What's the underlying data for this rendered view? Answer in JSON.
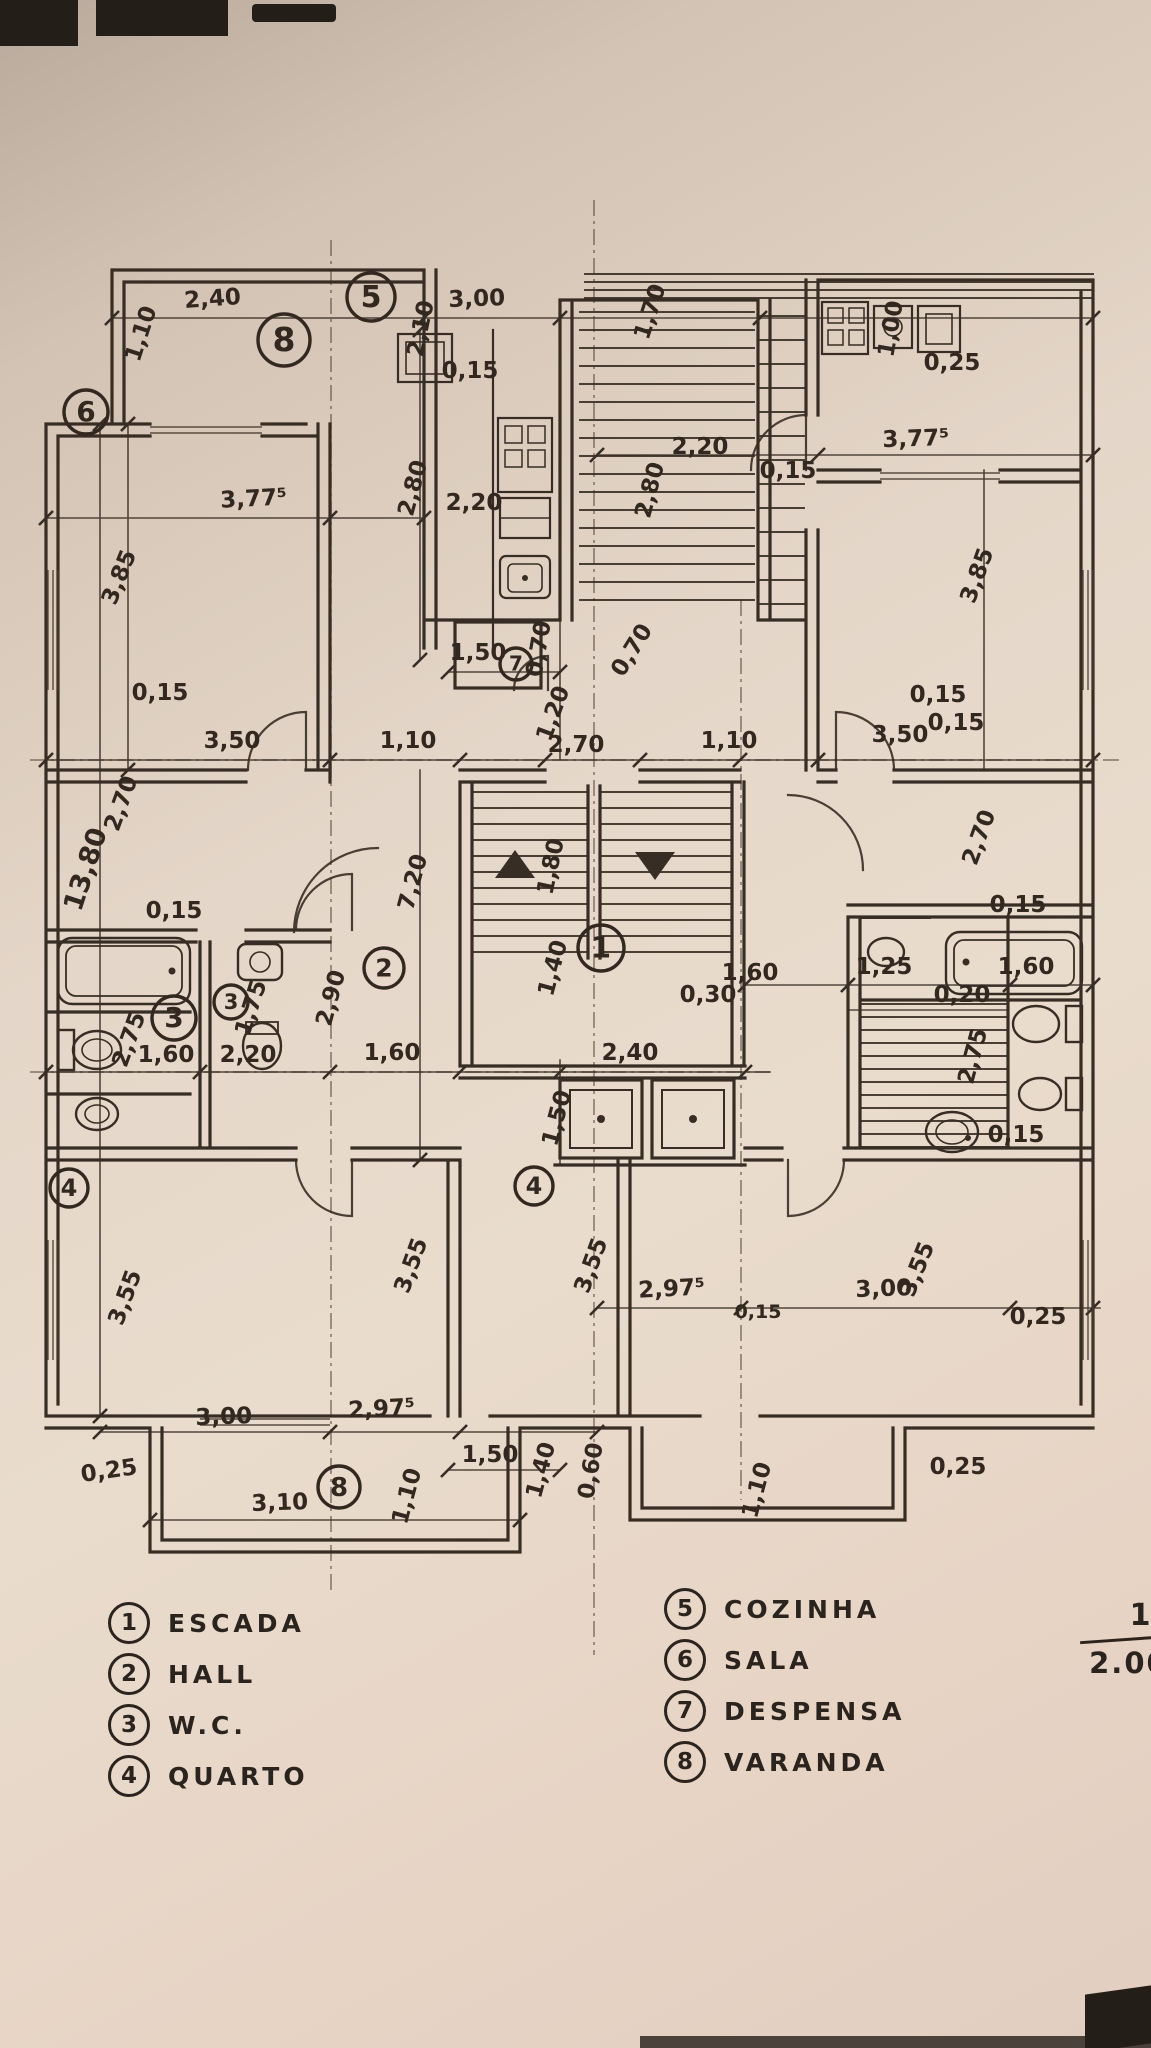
{
  "drawing": {
    "type": "floor plan (planta baixa)",
    "language": "pt",
    "ink_color": "#372d24",
    "paper_color": "#e7dacc"
  },
  "scale": {
    "numerator": "1",
    "denominator": "2.000"
  },
  "legend": {
    "items": [
      {
        "num": "1",
        "label": "ESCADA"
      },
      {
        "num": "2",
        "label": "HALL"
      },
      {
        "num": "3",
        "label": "W.C."
      },
      {
        "num": "4",
        "label": "QUARTO"
      },
      {
        "num": "5",
        "label": "COZINHA"
      },
      {
        "num": "6",
        "label": "SALA"
      },
      {
        "num": "7",
        "label": "DESPENSA"
      },
      {
        "num": "8",
        "label": "VARANDA"
      }
    ]
  },
  "room_markers": [
    {
      "num": "6",
      "x": 86,
      "y": 412,
      "r": 22
    },
    {
      "num": "8",
      "x": 284,
      "y": 340,
      "r": 26
    },
    {
      "num": "5",
      "x": 371,
      "y": 297,
      "r": 24
    },
    {
      "num": "7",
      "x": 516,
      "y": 664,
      "r": 16
    },
    {
      "num": "2",
      "x": 384,
      "y": 968,
      "r": 20
    },
    {
      "num": "3",
      "x": 174,
      "y": 1018,
      "r": 22
    },
    {
      "num": "3",
      "x": 231,
      "y": 1002,
      "r": 17
    },
    {
      "num": "1",
      "x": 601,
      "y": 948,
      "r": 23
    },
    {
      "num": "4",
      "x": 69,
      "y": 1188,
      "r": 19
    },
    {
      "num": "4",
      "x": 534,
      "y": 1186,
      "r": 19
    },
    {
      "num": "8",
      "x": 339,
      "y": 1487,
      "r": 21
    }
  ],
  "dimensions": [
    {
      "t": "1,10",
      "x": 148,
      "y": 336,
      "r": -72
    },
    {
      "t": "2,40",
      "x": 213,
      "y": 306,
      "r": -4
    },
    {
      "t": "3,00",
      "x": 477,
      "y": 306,
      "r": -2
    },
    {
      "t": "2,10",
      "x": 428,
      "y": 330,
      "r": -78
    },
    {
      "t": "0,15",
      "x": 470,
      "y": 378,
      "r": 0
    },
    {
      "t": "1,70",
      "x": 657,
      "y": 314,
      "r": -72
    },
    {
      "t": "1,00",
      "x": 898,
      "y": 330,
      "r": -80
    },
    {
      "t": "0,25",
      "x": 952,
      "y": 370,
      "r": 0
    },
    {
      "t": "3,77⁵",
      "x": 916,
      "y": 446,
      "r": -2
    },
    {
      "t": "0,15",
      "x": 788,
      "y": 478,
      "r": 0
    },
    {
      "t": "2,20",
      "x": 700,
      "y": 454,
      "r": 0
    },
    {
      "t": "3,77⁵",
      "x": 254,
      "y": 506,
      "r": -3
    },
    {
      "t": "2,20",
      "x": 474,
      "y": 510,
      "r": 0
    },
    {
      "t": "2,80",
      "x": 420,
      "y": 490,
      "r": -75
    },
    {
      "t": "2,80",
      "x": 657,
      "y": 492,
      "r": -75
    },
    {
      "t": "3,85",
      "x": 126,
      "y": 580,
      "r": -68
    },
    {
      "t": "3,85",
      "x": 984,
      "y": 578,
      "r": -70
    },
    {
      "t": "1,50",
      "x": 478,
      "y": 660,
      "r": 0
    },
    {
      "t": "0,70",
      "x": 546,
      "y": 650,
      "r": -80
    },
    {
      "t": "0,70",
      "x": 638,
      "y": 654,
      "r": -58
    },
    {
      "t": "1,20",
      "x": 560,
      "y": 716,
      "r": -70
    },
    {
      "t": "0,15",
      "x": 160,
      "y": 700,
      "r": 0
    },
    {
      "t": "0,15",
      "x": 938,
      "y": 702,
      "r": 0
    },
    {
      "t": "3,50",
      "x": 232,
      "y": 748,
      "r": 0
    },
    {
      "t": "1,10",
      "x": 408,
      "y": 748,
      "r": 0
    },
    {
      "t": "2,70",
      "x": 576,
      "y": 752,
      "r": 0
    },
    {
      "t": "1,10",
      "x": 729,
      "y": 748,
      "r": 0
    },
    {
      "t": "3,50",
      "x": 900,
      "y": 742,
      "r": 0
    },
    {
      "t": "0,15",
      "x": 956,
      "y": 730,
      "r": 0
    },
    {
      "t": "13,80",
      "x": 94,
      "y": 872,
      "r": -72,
      "s": 27
    },
    {
      "t": "2,70",
      "x": 128,
      "y": 806,
      "r": -70
    },
    {
      "t": "2,70",
      "x": 986,
      "y": 840,
      "r": -70
    },
    {
      "t": "7,20",
      "x": 420,
      "y": 884,
      "r": -75
    },
    {
      "t": "1,80",
      "x": 558,
      "y": 868,
      "r": -78
    },
    {
      "t": "0,15",
      "x": 174,
      "y": 918,
      "r": 0
    },
    {
      "t": "0,15",
      "x": 1018,
      "y": 912,
      "r": 0
    },
    {
      "t": "1,40",
      "x": 560,
      "y": 970,
      "r": -75
    },
    {
      "t": "1,60",
      "x": 750,
      "y": 980,
      "r": 0
    },
    {
      "t": "0,30",
      "x": 708,
      "y": 1002,
      "r": 0
    },
    {
      "t": "2,75",
      "x": 136,
      "y": 1042,
      "r": -70
    },
    {
      "t": "1,75",
      "x": 258,
      "y": 1010,
      "r": -72
    },
    {
      "t": "2,90",
      "x": 338,
      "y": 1000,
      "r": -75
    },
    {
      "t": "1,60",
      "x": 166,
      "y": 1062,
      "r": 0
    },
    {
      "t": "2,20",
      "x": 248,
      "y": 1062,
      "r": 0
    },
    {
      "t": "1,60",
      "x": 392,
      "y": 1060,
      "r": 0
    },
    {
      "t": "1,25",
      "x": 884,
      "y": 974,
      "r": 0
    },
    {
      "t": "1,60",
      "x": 1026,
      "y": 974,
      "r": 0
    },
    {
      "t": "0,20",
      "x": 962,
      "y": 1002,
      "r": 0
    },
    {
      "t": "2,75",
      "x": 980,
      "y": 1058,
      "r": -75
    },
    {
      "t": "0,15",
      "x": 1016,
      "y": 1142,
      "r": 0
    },
    {
      "t": "2,40",
      "x": 630,
      "y": 1060,
      "r": 0
    },
    {
      "t": "1,50",
      "x": 564,
      "y": 1120,
      "r": -75
    },
    {
      "t": "3,55",
      "x": 132,
      "y": 1300,
      "r": -70
    },
    {
      "t": "3,55",
      "x": 418,
      "y": 1268,
      "r": -70
    },
    {
      "t": "3,55",
      "x": 598,
      "y": 1268,
      "r": -70
    },
    {
      "t": "3,55",
      "x": 924,
      "y": 1272,
      "r": -68
    },
    {
      "t": "2,97⁵",
      "x": 672,
      "y": 1296,
      "r": -3
    },
    {
      "t": "3,00",
      "x": 884,
      "y": 1296,
      "r": -2
    },
    {
      "t": "0,15",
      "x": 758,
      "y": 1318,
      "r": 0,
      "s": 19
    },
    {
      "t": "0,25",
      "x": 1038,
      "y": 1324,
      "r": 0
    },
    {
      "t": "3,00",
      "x": 224,
      "y": 1424,
      "r": -2
    },
    {
      "t": "2,97⁵",
      "x": 382,
      "y": 1416,
      "r": -3
    },
    {
      "t": "0,25",
      "x": 110,
      "y": 1478,
      "r": -8
    },
    {
      "t": "3,10",
      "x": 280,
      "y": 1510,
      "r": -2
    },
    {
      "t": "1,10",
      "x": 414,
      "y": 1498,
      "r": -75
    },
    {
      "t": "1,50",
      "x": 490,
      "y": 1462,
      "r": 0
    },
    {
      "t": "1,40",
      "x": 548,
      "y": 1472,
      "r": -75
    },
    {
      "t": "0,60",
      "x": 598,
      "y": 1472,
      "r": -80
    },
    {
      "t": "1,10",
      "x": 764,
      "y": 1492,
      "r": -75
    },
    {
      "t": "0,25",
      "x": 958,
      "y": 1474,
      "r": 0
    }
  ]
}
